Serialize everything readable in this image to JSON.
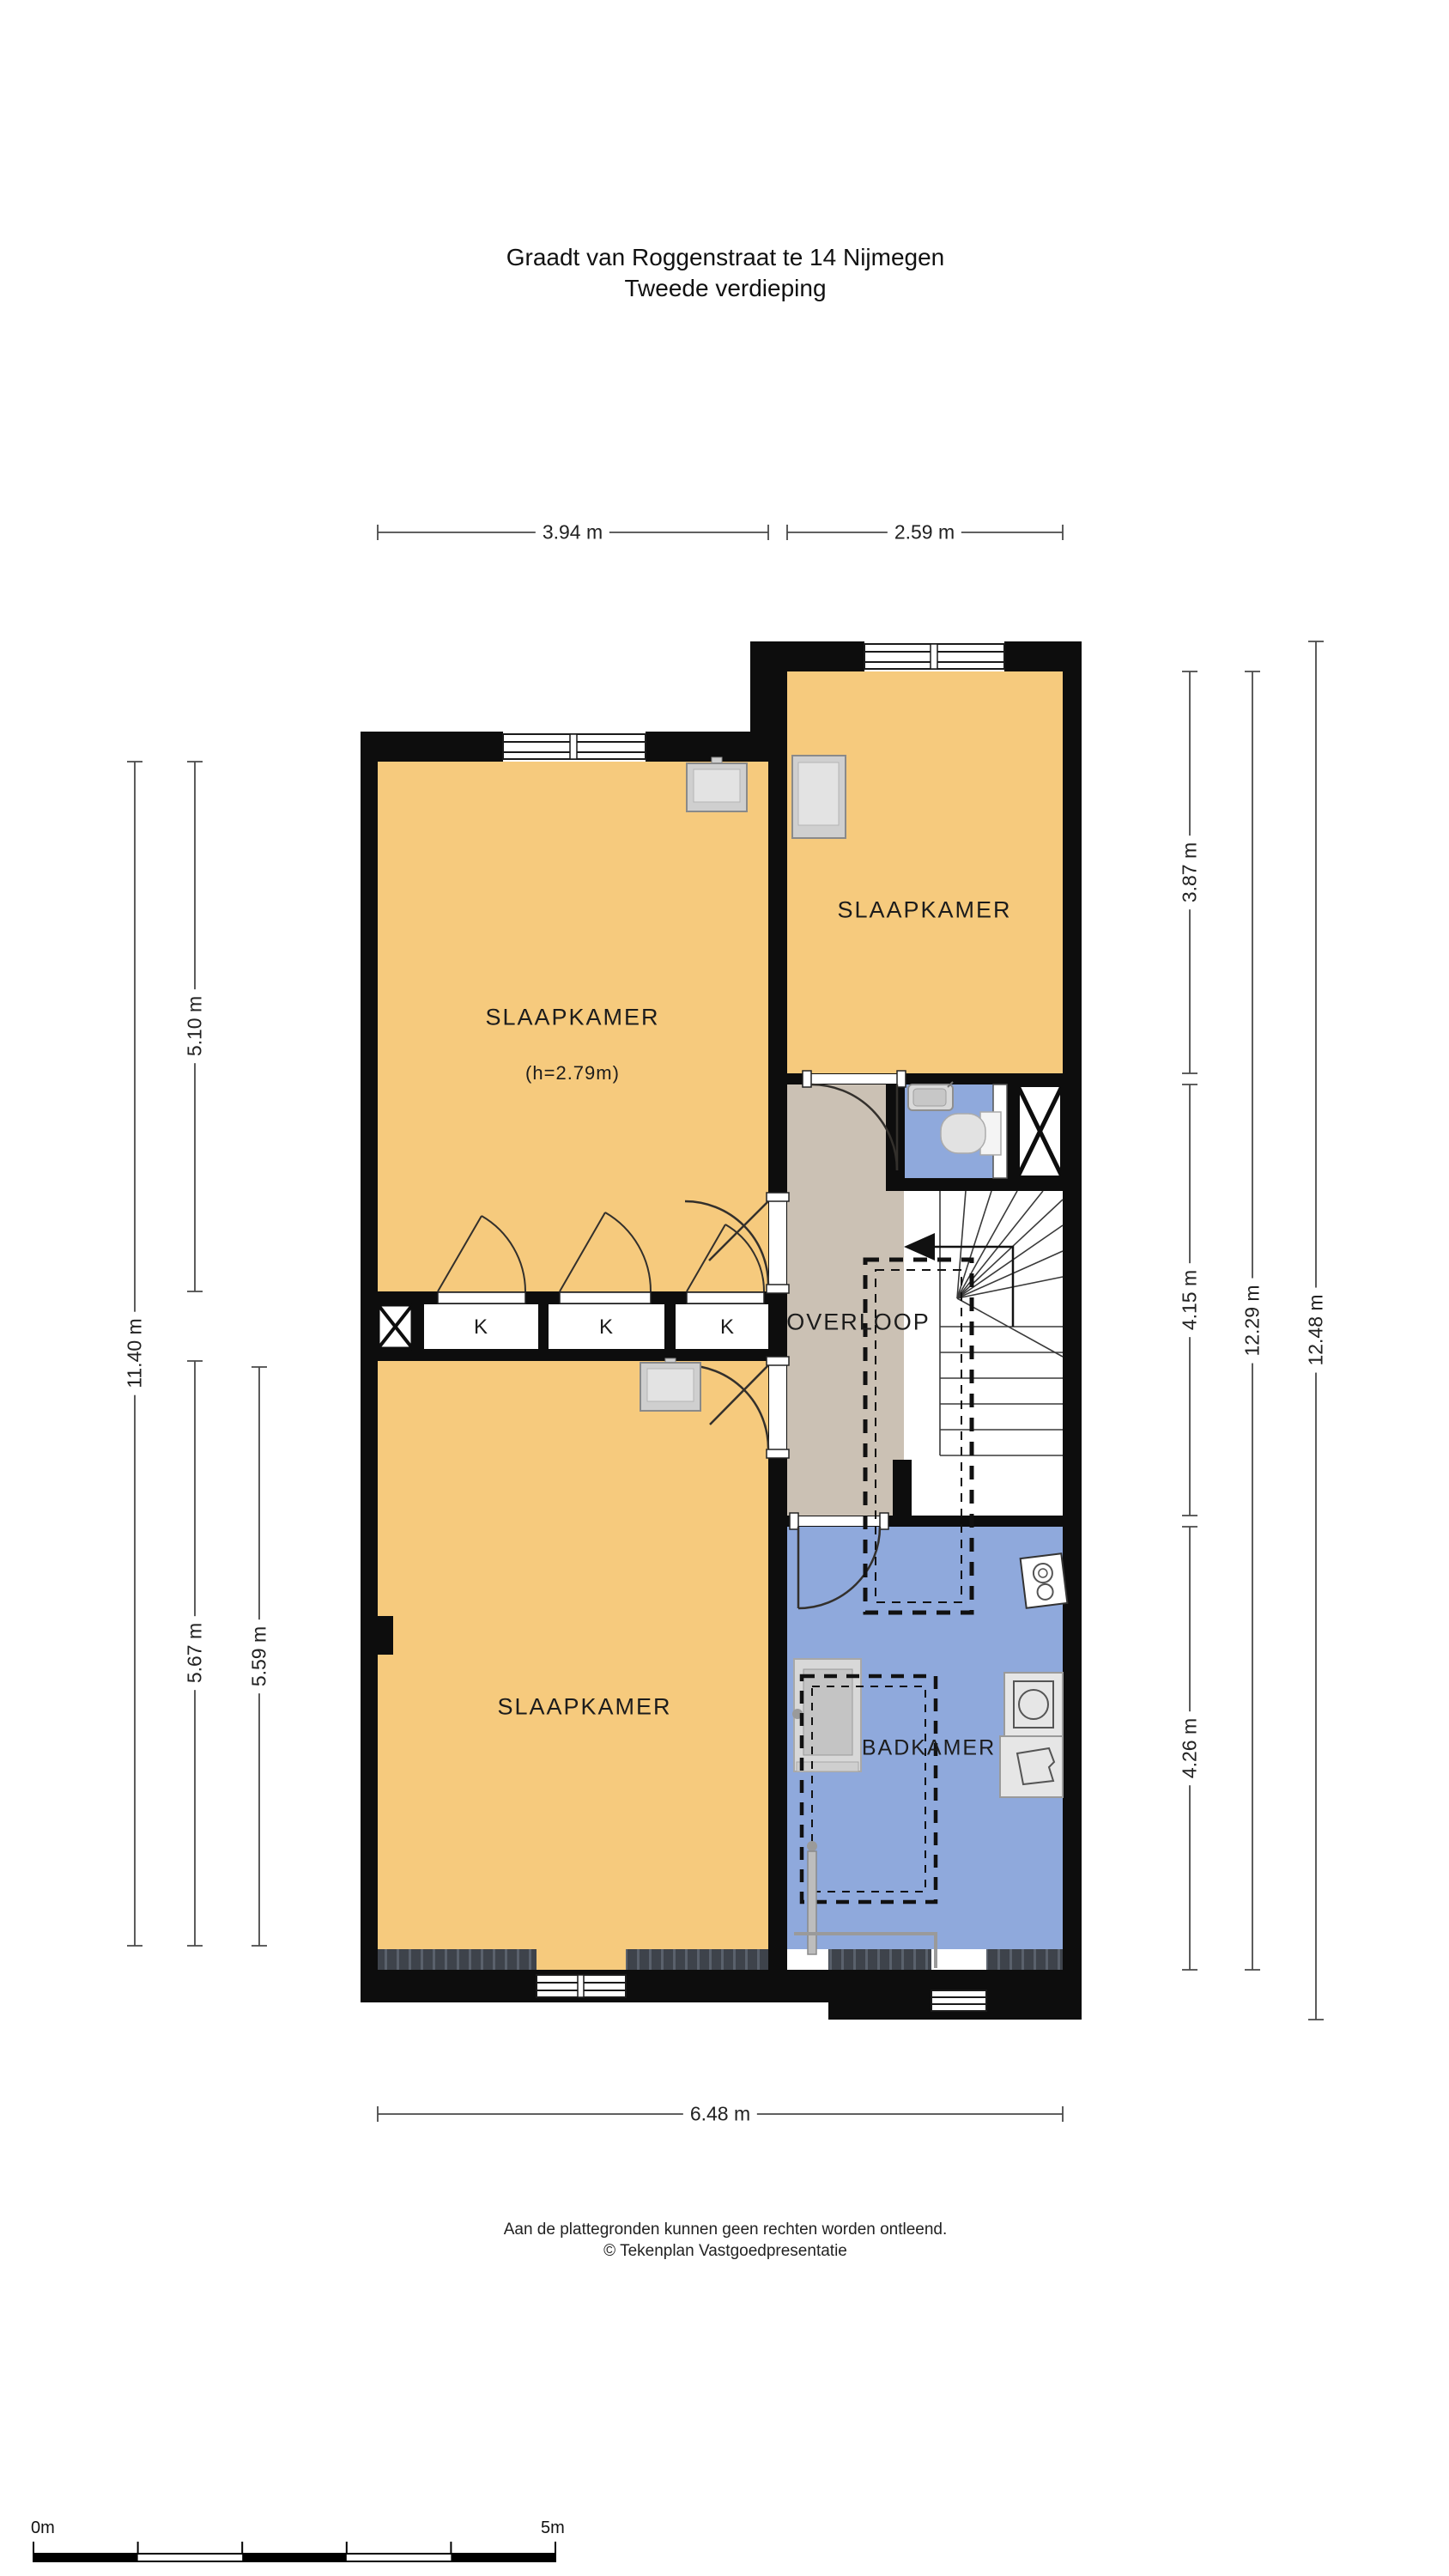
{
  "title": {
    "line1": "Graadt van Roggenstraat te 14 Nijmegen",
    "line2": "Tweede verdieping"
  },
  "rooms": {
    "bedroom_top_left": {
      "label": "SLAAPKAMER",
      "height_note": "(h=2.79m)"
    },
    "bedroom_top_right": {
      "label": "SLAAPKAMER"
    },
    "bedroom_bottom": {
      "label": "SLAAPKAMER"
    },
    "landing": {
      "label": "OVERLOOP"
    },
    "bathroom": {
      "label": "BADKAMER"
    },
    "closets": {
      "label": "K"
    }
  },
  "dimensions": {
    "top_left": "3.94 m",
    "top_right": "2.59 m",
    "bottom": "6.48 m",
    "left_total": "11.40 m",
    "left_upper": "5.10 m",
    "left_lower_outer": "5.67 m",
    "left_lower_inner": "5.59 m",
    "right_upper": "3.87 m",
    "right_middle": "4.15 m",
    "right_lower": "4.26 m",
    "right_inner_total": "12.29 m",
    "right_outer_total": "12.48 m"
  },
  "footer": {
    "disclaimer": "Aan de plattegronden kunnen geen rechten worden ontleend.",
    "copyright": "© Tekenplan Vastgoedpresentatie"
  },
  "scale_bar": {
    "start_label": "0m",
    "end_label": "5m"
  },
  "colors": {
    "room_fill": "#F6CA7D",
    "landing_fill": "#CBC1B4",
    "bath_fill": "#8FA9DC",
    "wall": "#0D0D0D",
    "closet_fill": "#E8E8E8",
    "roof_edge": "#3E434B"
  }
}
